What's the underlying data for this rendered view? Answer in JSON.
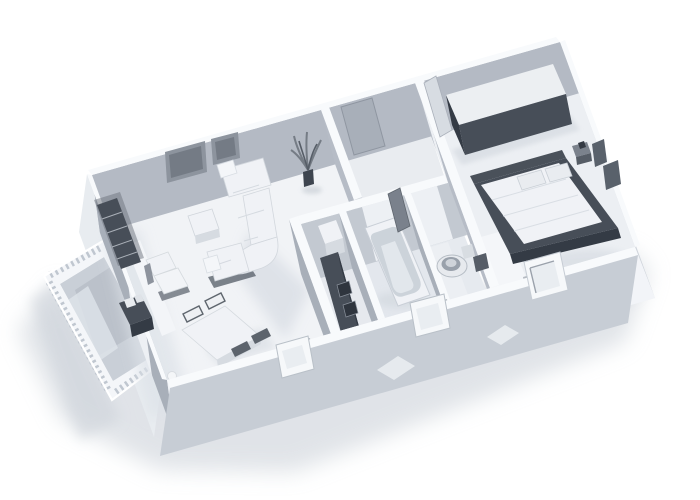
{
  "view": {
    "type": "isometric-3d-apartment-render",
    "style": "monochrome-white-architectural-model",
    "background": "#ffffff"
  },
  "colors": {
    "background": "#ffffff",
    "shadow": "#ccd2d9",
    "shadow_dark": "#c3cad2",
    "wall_top": "#f8fafc",
    "wall_back": "#b4bac4",
    "wall_side": "#a8afb9",
    "wall_interior": "#b6bcc6",
    "wall_divider": "#c3c9d1",
    "wall_east": "#d0d5dc",
    "wall_exterior_left": "#e8ecf0",
    "wall_front_inner": "#f2f4f8",
    "wall_front_outer": "#c7cdd5",
    "opening": "#edf0f4",
    "window": "#f6f8fa",
    "door_panel": "#d7dce2",
    "floor_living": "#f1f3f6",
    "floor_hall": "#e9ecf0",
    "floor_kitchen": "#e6e9ee",
    "floor_bath": "#e3e7ed",
    "floor_wc": "#e6eaef",
    "floor_bedroom": "#eceff3",
    "balcony_floor": "#c9cfd7",
    "railing": "#f4f6f9",
    "furniture_white": "#f0f2f6",
    "furniture_shade": "#d6dbe1",
    "furniture_dark": "#474e58",
    "furniture_darker": "#343b45",
    "frame_dark": "#59616b"
  },
  "rooms": [
    {
      "name": "living-room",
      "objects": [
        "sectional-sofa",
        "coffee-table",
        "armchair",
        "dining-table",
        "dining-chairs",
        "wall-frames",
        "shelving-unit",
        "sideboard"
      ]
    },
    {
      "name": "hallway",
      "objects": [
        "entrance-door",
        "potted-plant"
      ]
    },
    {
      "name": "kitchen",
      "objects": [
        "refrigerator",
        "counter",
        "sink"
      ]
    },
    {
      "name": "bathroom",
      "objects": [
        "bathtub",
        "door-panel"
      ]
    },
    {
      "name": "wc",
      "objects": [
        "toilet",
        "cabinet"
      ]
    },
    {
      "name": "bedroom",
      "objects": [
        "double-bed",
        "pillows",
        "wardrobe",
        "nightstand",
        "picture-frames",
        "door"
      ]
    },
    {
      "name": "balcony",
      "objects": [
        "railing"
      ]
    }
  ]
}
